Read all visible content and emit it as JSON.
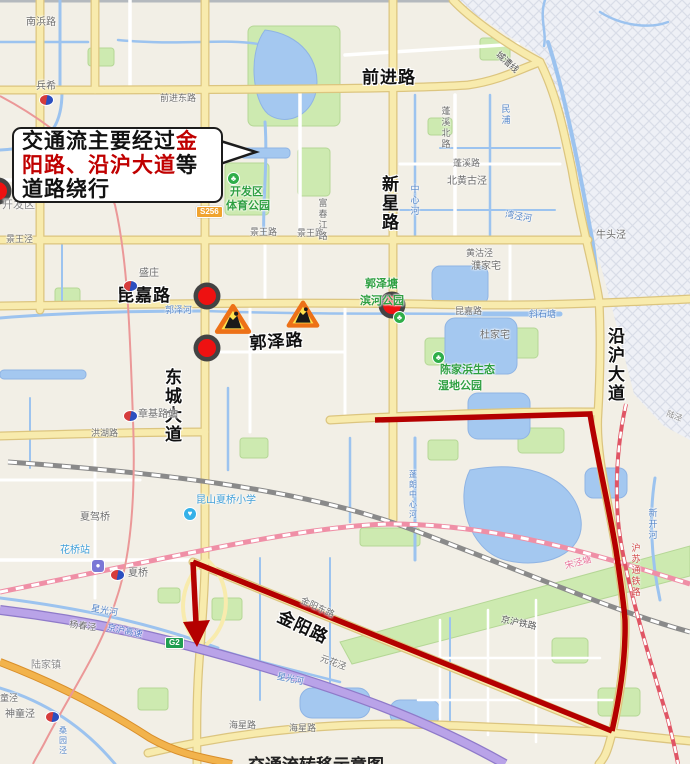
{
  "callout": {
    "line1_black": "交通流主要经过",
    "line1_red": "金",
    "line2_red": "阳路、沿沪大道",
    "line2_black": "等",
    "line3_black": "道路绕行"
  },
  "caption": {
    "text": "交通流转移示意图"
  },
  "colors": {
    "route_red": "#b40000",
    "marker_red": "#ee1111",
    "marker_ring": "#434343",
    "triangle_orange": "#ed7117",
    "triangle_yellow": "#ffe24d",
    "callout_red": "#c00000",
    "highway_purple": "#b9a3e8",
    "road_yellow": "#f8ebad",
    "water_blue": "#9cc3ef",
    "park_green": "#cdeab0"
  },
  "road_labels_major": [
    {
      "id": "label-qianjin-lu",
      "t": "前进路",
      "x": 362,
      "y": 69
    },
    {
      "id": "label-xinxing-lu",
      "t": "新星路",
      "x": 379,
      "y": 175,
      "v": 1
    },
    {
      "id": "label-kunjia-lu",
      "t": "昆嘉路",
      "x": 117,
      "y": 287
    },
    {
      "id": "label-guoze-lu",
      "t": "郭泽路",
      "x": 249,
      "y": 335,
      "r": -4
    },
    {
      "id": "label-dongcheng-dadao",
      "t": "东城大道",
      "x": 162,
      "y": 368,
      "v": 1
    },
    {
      "id": "label-yanhu-dadao",
      "t": "沿沪大道",
      "x": 605,
      "y": 327,
      "v": 1
    },
    {
      "id": "label-jinyang-lu",
      "t": "金阳路",
      "x": 282,
      "y": 608,
      "r": 25
    }
  ],
  "map_labels": [
    {
      "id": "label-nanbang-lu",
      "t": "南浜路",
      "x": 26,
      "y": 18,
      "c": "#6d6d6d"
    },
    {
      "id": "label-bingxi",
      "t": "兵希",
      "x": 36,
      "y": 82,
      "c": "#6d6d6d"
    },
    {
      "id": "label-shengzhuang",
      "t": "盛庄",
      "x": 139,
      "y": 269,
      "c": "#6d6d6d"
    },
    {
      "id": "label-kaifaqu",
      "t": "开发区",
      "x": 2,
      "y": 200,
      "c": "#8a8a8a",
      "fs": 11
    },
    {
      "id": "label-jingwang-jing",
      "t": "景王泾",
      "x": 6,
      "y": 235,
      "c": "#6d6d6d",
      "fs": 9
    },
    {
      "id": "label-qianjindong-lu",
      "t": "前进东路",
      "x": 160,
      "y": 94,
      "c": "#6d6d6d",
      "fs": 9
    },
    {
      "id": "label-jingwang-lu-1",
      "t": "景王路",
      "x": 250,
      "y": 228,
      "c": "#6d6d6d",
      "fs": 9
    },
    {
      "id": "label-jingwang-lu-2",
      "t": "景王路",
      "x": 297,
      "y": 229,
      "c": "#6d6d6d",
      "fs": 9
    },
    {
      "id": "label-fuchunjiang-lu",
      "t": "富春江路",
      "x": 317,
      "y": 198,
      "c": "#6d6d6d",
      "fs": 9,
      "v": 1
    },
    {
      "id": "label-zhongxin-he",
      "t": "中心河",
      "x": 409,
      "y": 184,
      "c": "#5586c8",
      "fs": 9,
      "v": 1
    },
    {
      "id": "label-minpu",
      "t": "民浦",
      "x": 500,
      "y": 104,
      "c": "#5586c8",
      "fs": 9,
      "v": 1
    },
    {
      "id": "label-pengxibei-lu",
      "t": "蓬溪北路",
      "x": 440,
      "y": 106,
      "c": "#6d6d6d",
      "fs": 9,
      "v": 1
    },
    {
      "id": "label-pengxi-lu",
      "t": "蓬溪路",
      "x": 453,
      "y": 159,
      "c": "#6d6d6d",
      "fs": 9
    },
    {
      "id": "label-beihuanggu-jing",
      "t": "北黄古泾",
      "x": 447,
      "y": 177,
      "c": "#6d6d6d"
    },
    {
      "id": "label-wanjing-he",
      "t": "湾泾河",
      "x": 506,
      "y": 210,
      "c": "#5586c8",
      "fs": 9,
      "r": 10
    },
    {
      "id": "label-niutou-jing",
      "t": "牛头泾",
      "x": 596,
      "y": 231,
      "c": "#6d6d6d"
    },
    {
      "id": "label-chengcao-xian",
      "t": "城漕线",
      "x": 500,
      "y": 50,
      "c": "#555555",
      "fs": 9,
      "r": 42
    },
    {
      "id": "label-huanggu-jing",
      "t": "黄沽泾",
      "x": 466,
      "y": 249,
      "c": "#6d6d6d",
      "fs": 9
    },
    {
      "id": "label-pujiazhai",
      "t": "濮家宅",
      "x": 471,
      "y": 262,
      "c": "#6d6d6d"
    },
    {
      "id": "label-dujiazhai",
      "t": "杜家宅",
      "x": 480,
      "y": 331,
      "c": "#6d6d6d"
    },
    {
      "id": "label-guoze-he",
      "t": "郭泽河",
      "x": 165,
      "y": 306,
      "c": "#5586c8",
      "fs": 9
    },
    {
      "id": "label-xieshitang",
      "t": "斜石塘",
      "x": 529,
      "y": 310,
      "c": "#5586c8",
      "fs": 9
    },
    {
      "id": "label-kunjia-lu-small",
      "t": "昆嘉路",
      "x": 455,
      "y": 307,
      "c": "#6d6d6d",
      "fs": 9
    },
    {
      "id": "label-honghu-lu",
      "t": "洪湖路",
      "x": 91,
      "y": 429,
      "c": "#6d6d6d",
      "fs": 9
    },
    {
      "id": "label-xiajia-qiao",
      "t": "夏驾桥",
      "x": 80,
      "y": 513,
      "c": "#6d6d6d"
    },
    {
      "id": "label-xiaqiao-xiaoxue",
      "t": "昆山夏桥小学",
      "x": 196,
      "y": 496,
      "c": "#3f9fd8"
    },
    {
      "id": "label-zhangjilu-zhan",
      "t": "章基路站",
      "x": 138,
      "y": 410,
      "c": "#6d6d6d"
    },
    {
      "id": "label-huaqiao-zhan",
      "t": "花桥站",
      "x": 60,
      "y": 546,
      "c": "#3f9fd8"
    },
    {
      "id": "label-xiaqiao",
      "t": "夏桥",
      "x": 128,
      "y": 569,
      "c": "#6d6d6d"
    },
    {
      "id": "label-yangchun-jing",
      "t": "杨春泾",
      "x": 70,
      "y": 620,
      "c": "#6d6d6d",
      "fs": 9,
      "r": 8
    },
    {
      "id": "label-xingguang-he-1",
      "t": "星光河",
      "x": 92,
      "y": 604,
      "c": "#5586c8",
      "fs": 9,
      "r": 10
    },
    {
      "id": "label-xingguang-he-2",
      "t": "星光河",
      "x": 278,
      "y": 672,
      "c": "#5586c8",
      "fs": 9,
      "r": 12
    },
    {
      "id": "label-lujia-zhen",
      "t": "陆家镇",
      "x": 31,
      "y": 661,
      "c": "#8a8a8a"
    },
    {
      "id": "label-tong-jing",
      "t": "童泾",
      "x": 0,
      "y": 694,
      "c": "#6d6d6d",
      "fs": 9
    },
    {
      "id": "label-shentong-jing",
      "t": "神童泾",
      "x": 5,
      "y": 710,
      "c": "#6d6d6d"
    },
    {
      "id": "label-sangyuan-jing",
      "t": "桑园泾",
      "x": 58,
      "y": 726,
      "c": "#5586c8",
      "fs": 8,
      "v": 1
    },
    {
      "id": "label-jinghu-gaosu",
      "t": "京沪高速",
      "x": 108,
      "y": 623,
      "c": "#4f74c8",
      "fs": 9,
      "r": 12
    },
    {
      "id": "label-jinghu-tielu",
      "t": "京沪铁路",
      "x": 502,
      "y": 615,
      "c": "#555555",
      "fs": 9,
      "r": 12
    },
    {
      "id": "label-songjing-tang",
      "t": "宋泾塘",
      "x": 564,
      "y": 562,
      "c": "#e8739a",
      "fs": 9,
      "r": -15
    },
    {
      "id": "label-husutong-tielu",
      "t": "沪苏通铁路",
      "x": 630,
      "y": 543,
      "c": "#d04545",
      "fs": 9,
      "v": 1
    },
    {
      "id": "label-xinkai-he",
      "t": "新开河",
      "x": 647,
      "y": 508,
      "c": "#5586c8",
      "fs": 9,
      "v": 1
    },
    {
      "id": "label-penglang-zhongxinhe",
      "t": "蓬朗中心河",
      "x": 408,
      "y": 470,
      "c": "#5586c8",
      "fs": 8,
      "v": 1
    },
    {
      "id": "label-jinyangdong-lu",
      "t": "金阳东路",
      "x": 303,
      "y": 596,
      "c": "#6d6d6d",
      "fs": 9,
      "r": 25
    },
    {
      "id": "label-yuanhua-jing",
      "t": "元花泾",
      "x": 322,
      "y": 654,
      "c": "#6d6d6d",
      "fs": 9,
      "r": 20
    },
    {
      "id": "label-haixing-lu-1",
      "t": "海星路",
      "x": 229,
      "y": 721,
      "c": "#6d6d6d",
      "fs": 9
    },
    {
      "id": "label-haixing-lu-2",
      "t": "海星路",
      "x": 289,
      "y": 724,
      "c": "#6d6d6d",
      "fs": 9
    },
    {
      "id": "label-lu-jing",
      "t": "陆泾",
      "x": 668,
      "y": 410,
      "c": "#8a8a8a",
      "fs": 8,
      "r": 20
    },
    {
      "id": "label-park-kaifaqu-1",
      "t": "开发区",
      "x": 230,
      "y": 187,
      "c": "#2fa042",
      "fs": 11,
      "bold": 1
    },
    {
      "id": "label-park-kaifaqu-2",
      "t": "体育公园",
      "x": 226,
      "y": 201,
      "c": "#2fa042",
      "fs": 11,
      "bold": 1
    },
    {
      "id": "label-park-guozetang",
      "t": "郭泽塘",
      "x": 365,
      "y": 279,
      "c": "#2fa042",
      "fs": 11,
      "bold": 1
    },
    {
      "id": "label-park-binhe",
      "t": "滨河公园",
      "x": 360,
      "y": 296,
      "c": "#2fa042",
      "fs": 11,
      "bold": 1
    },
    {
      "id": "label-park-chenjiabang",
      "t": "陈家浜生态",
      "x": 440,
      "y": 365,
      "c": "#2fa042",
      "fs": 11,
      "bold": 1
    },
    {
      "id": "label-park-shidi",
      "t": "湿地公园",
      "x": 438,
      "y": 381,
      "c": "#2fa042",
      "fs": 11,
      "bold": 1
    }
  ],
  "badges": [
    {
      "id": "badge-s256",
      "t": "S256",
      "x": 196,
      "y": 206,
      "bg": "#f0a32f"
    },
    {
      "id": "badge-g2",
      "t": "G2",
      "x": 165,
      "y": 637,
      "bg": "#1f9e50"
    }
  ],
  "icons": [
    {
      "id": "metro-icon-bingxi",
      "type": "metro",
      "x": 40,
      "y": 95
    },
    {
      "id": "metro-icon-shengzhuang",
      "type": "metro",
      "x": 124,
      "y": 281
    },
    {
      "id": "metro-icon-zhangji",
      "type": "metro",
      "x": 124,
      "y": 411
    },
    {
      "id": "metro-icon-xiaqiao",
      "type": "metro",
      "x": 111,
      "y": 570
    },
    {
      "id": "metro-icon-shentongjing",
      "type": "metro",
      "x": 46,
      "y": 712
    },
    {
      "id": "park-icon-tiyugongyuan",
      "type": "park",
      "x": 228,
      "y": 173
    },
    {
      "id": "park-icon-binhegongyuan",
      "type": "park",
      "x": 394,
      "y": 312
    },
    {
      "id": "park-icon-shidigongyuan",
      "type": "park",
      "x": 433,
      "y": 352
    },
    {
      "id": "school-icon-xiaqiaoxiaoxue",
      "type": "school",
      "x": 184,
      "y": 508
    },
    {
      "id": "station-icon-huaqiaozhan",
      "type": "station",
      "x": 92,
      "y": 560
    }
  ],
  "markers": {
    "circles": [
      {
        "x": 207,
        "y": 296
      },
      {
        "x": 207,
        "y": 348
      },
      {
        "x": 392,
        "y": 305
      }
    ],
    "half_circle": {
      "x": -2,
      "y": 191
    },
    "triangles": [
      {
        "x": 233,
        "y": 320,
        "s": 1.05
      },
      {
        "x": 303,
        "y": 315,
        "s": 0.95
      }
    ]
  }
}
